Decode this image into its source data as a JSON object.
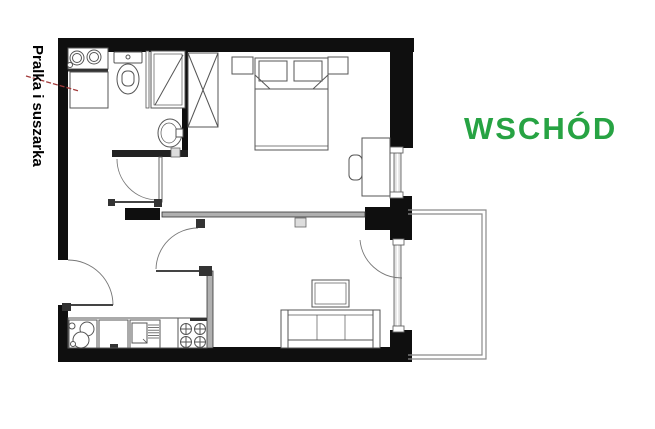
{
  "page": {
    "kind": "apartment floor plan screenshot",
    "background": "#ffffff"
  },
  "labels": {
    "washer_dryer": "Pralka i suszarka",
    "east_direction": "WSCHÓD"
  },
  "colors": {
    "wall": "#0f0f0f",
    "east_green": "#27a343",
    "arrow_red": "#a23b3b",
    "furniture_line": "#555555",
    "thin_wall_fill": "#b0b0b0"
  },
  "symbols": [
    "double-washbasin-icon",
    "washer-dryer-icon",
    "toilet-icon",
    "shower-icon",
    "hand-basin-icon",
    "wardrobe-icon",
    "double-bed-icon",
    "nightstand-icon",
    "desk-icon",
    "chair-icon",
    "kitchen-sink-icon",
    "cooktop-4-burner-icon",
    "sofa-3-seat-icon",
    "coffee-table-icon",
    "balcony-icon",
    "entry-door-icon",
    "interior-door-icon",
    "window-icon",
    "balcony-door-icon"
  ]
}
